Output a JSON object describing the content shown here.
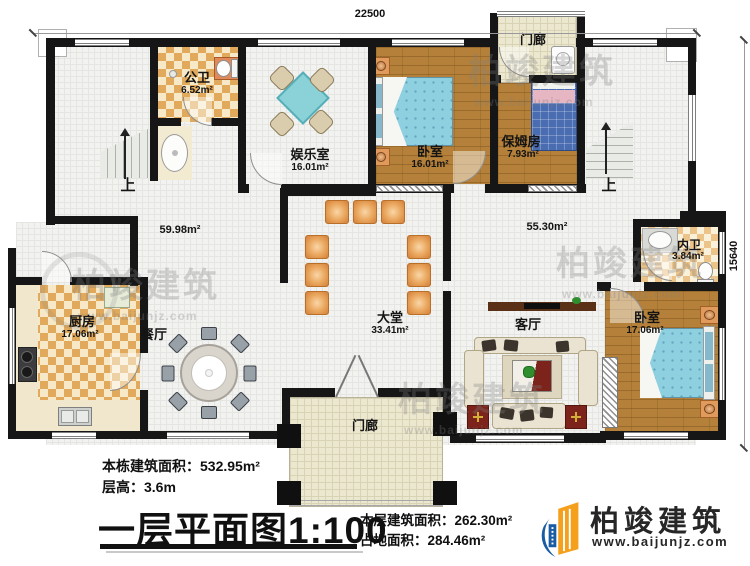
{
  "dimensions": {
    "top_width": "22500",
    "right_height": "15640"
  },
  "rooms": {
    "public_bath": {
      "name": "公卫",
      "area": "6.52m²"
    },
    "entertainment": {
      "name": "娱乐室",
      "area": "16.01m²"
    },
    "bedroom_top": {
      "name": "卧室",
      "area": "16.01m²"
    },
    "porch_top": {
      "name": "门廊"
    },
    "nanny_room": {
      "name": "保姆房",
      "area": "7.93m²"
    },
    "hall_left": {
      "area": "59.98m²"
    },
    "hall_right": {
      "area": "55.30m²"
    },
    "master_bath": {
      "name": "内卫",
      "area": "3.84m²"
    },
    "kitchen": {
      "name": "厨房",
      "area": "17.06m²"
    },
    "dining": {
      "name": "餐厅"
    },
    "lobby": {
      "name": "大堂",
      "area": "33.41m²"
    },
    "living": {
      "name": "客厅"
    },
    "bedroom_bottom": {
      "name": "卧室",
      "area": "17.06m²"
    },
    "porch_bottom": {
      "name": "门廊"
    },
    "stairs_left_label": "上",
    "stairs_right_label": "上"
  },
  "title_block": {
    "building_total_area": "本栋建筑面积：532.95m²",
    "floor_height": "层高：3.6m",
    "plan_title": "一层平面图",
    "plan_scale": "1:100",
    "floor_area": "本层建筑面积：262.30m²",
    "footprint_area": "占地面积：284.46m²"
  },
  "logo": {
    "company": "柏竣建筑",
    "website": "www.baijunjz.com"
  },
  "watermark": {
    "text": "柏竣建筑",
    "website": "www.baijunjz.com"
  },
  "colors": {
    "wall": "#161616",
    "wood_floor": "#b5813a",
    "checker_tile": "#e0a95c",
    "bed_blue": "#8fd0e0",
    "seat_orange": "#e9a55c",
    "logo_blue": "#1a5ca4",
    "logo_orange": "#f4a01c"
  }
}
